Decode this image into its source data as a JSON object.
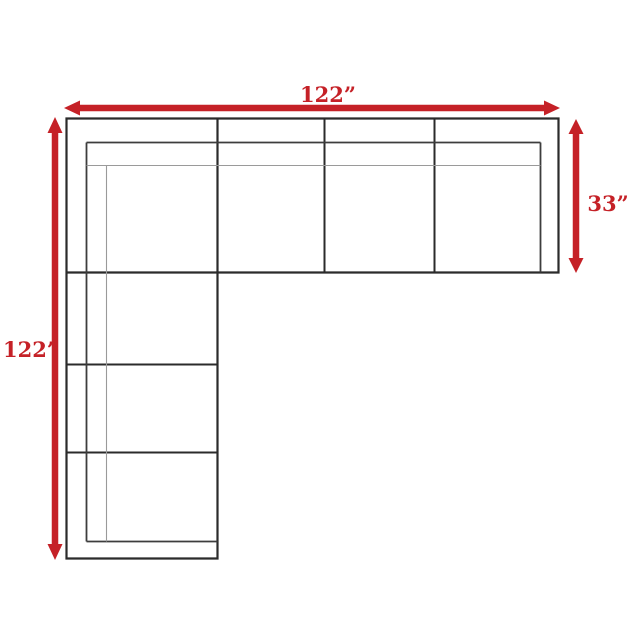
{
  "diagram": {
    "kind": "sectional-sofa-top-view-dimension-diagram",
    "labels": {
      "top_width": "122”",
      "left_depth": "122”",
      "right_depth": "33”"
    },
    "colors": {
      "outline": "#2b2b2b",
      "inner_line": "#3d3d3d",
      "seat_line": "#9a9a9a",
      "accent_red": "#c52127",
      "background": "#ffffff"
    }
  }
}
